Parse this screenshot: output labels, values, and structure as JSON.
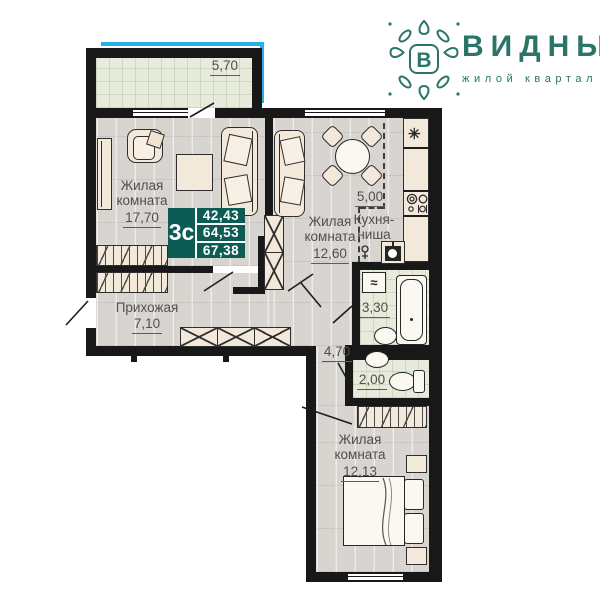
{
  "logo": {
    "title": "ВИДНЫЙ",
    "subtitle": "жилой квартал",
    "monogram": "В",
    "brand_color": "#2b7568"
  },
  "badge": {
    "type": "3с",
    "values": [
      "42,43",
      "64,53",
      "67,38"
    ],
    "bg_color": "#0d5c54"
  },
  "rooms": {
    "balcony": {
      "area": "5,70"
    },
    "living1": {
      "line1": "Жилая",
      "line2": "комната",
      "area": "17,70"
    },
    "living2": {
      "line1": "Жилая",
      "line2": "комната",
      "area": "12,60"
    },
    "kitchen": {
      "area": "5,00",
      "line1": "Кухня-",
      "line2": "ниша"
    },
    "hallway": {
      "name": "Прихожая",
      "area": "7,10"
    },
    "bathroom": {
      "area": "3,30"
    },
    "corridor": {
      "area": "4,70"
    },
    "wc": {
      "area": "2,00"
    },
    "bedroom": {
      "line1": "Жилая",
      "line2": "комната",
      "area": "12,13"
    }
  },
  "icons": {
    "fridge": "✳",
    "washer": "≈"
  },
  "colors": {
    "wall": "#181818",
    "accent_blue": "#2aaee6",
    "wood_floor": "#d8d5d1",
    "tile_floor": "#e7ebdc",
    "furniture": "#f3e9da",
    "label_text": "#4f4f4f"
  }
}
